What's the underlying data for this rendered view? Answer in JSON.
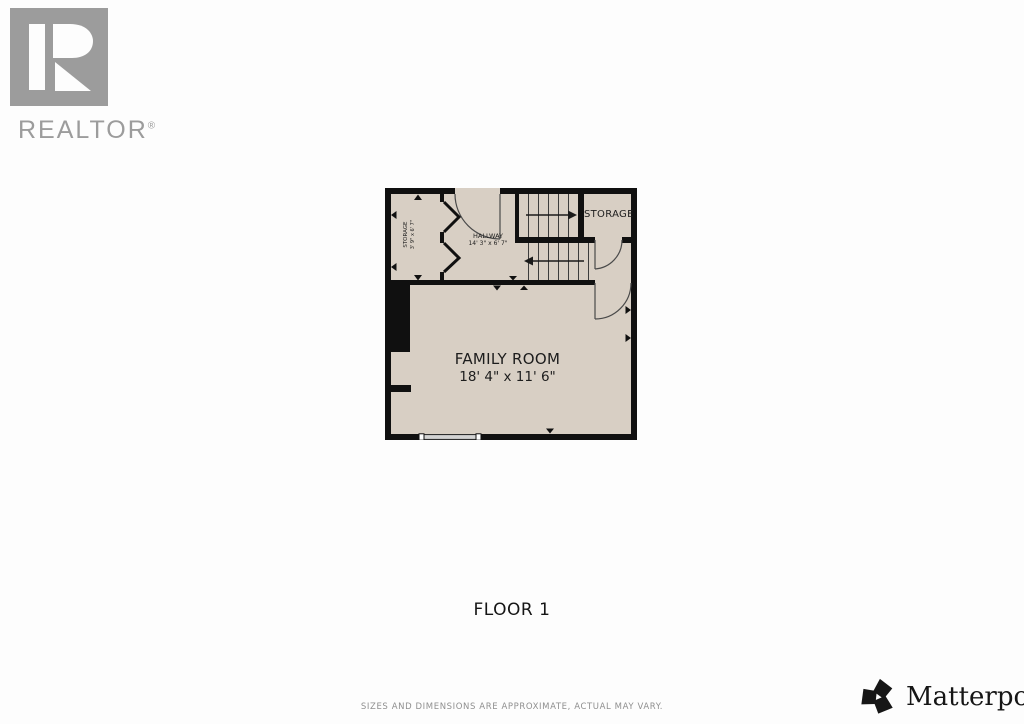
{
  "branding": {
    "realtor": {
      "wordmark": "REALTOR",
      "registered": "®"
    },
    "matterport": {
      "wordmark": "Matterport",
      "registered": "®"
    }
  },
  "plan": {
    "family_room": {
      "name": "FAMILY ROOM",
      "dims": "18' 4\" x 11' 6\""
    },
    "hallway": {
      "name": "HALLWAY",
      "dims": "14' 3\" x 6' 7\""
    },
    "storage_small": {
      "name": "STORAGE",
      "dims": "3' 9\" x 6' 7\""
    },
    "storage_right": {
      "name": "STORAGE"
    }
  },
  "footer": {
    "floor_label": "FLOOR 1",
    "disclaimer": "SIZES AND DIMENSIONS ARE APPROXIMATE, ACTUAL MAY VARY."
  },
  "colors": {
    "floor": "#d8cfc4",
    "wall": "#101010",
    "logo_gray": "#9c9c9c",
    "accent_text": "#1d1d1d"
  }
}
